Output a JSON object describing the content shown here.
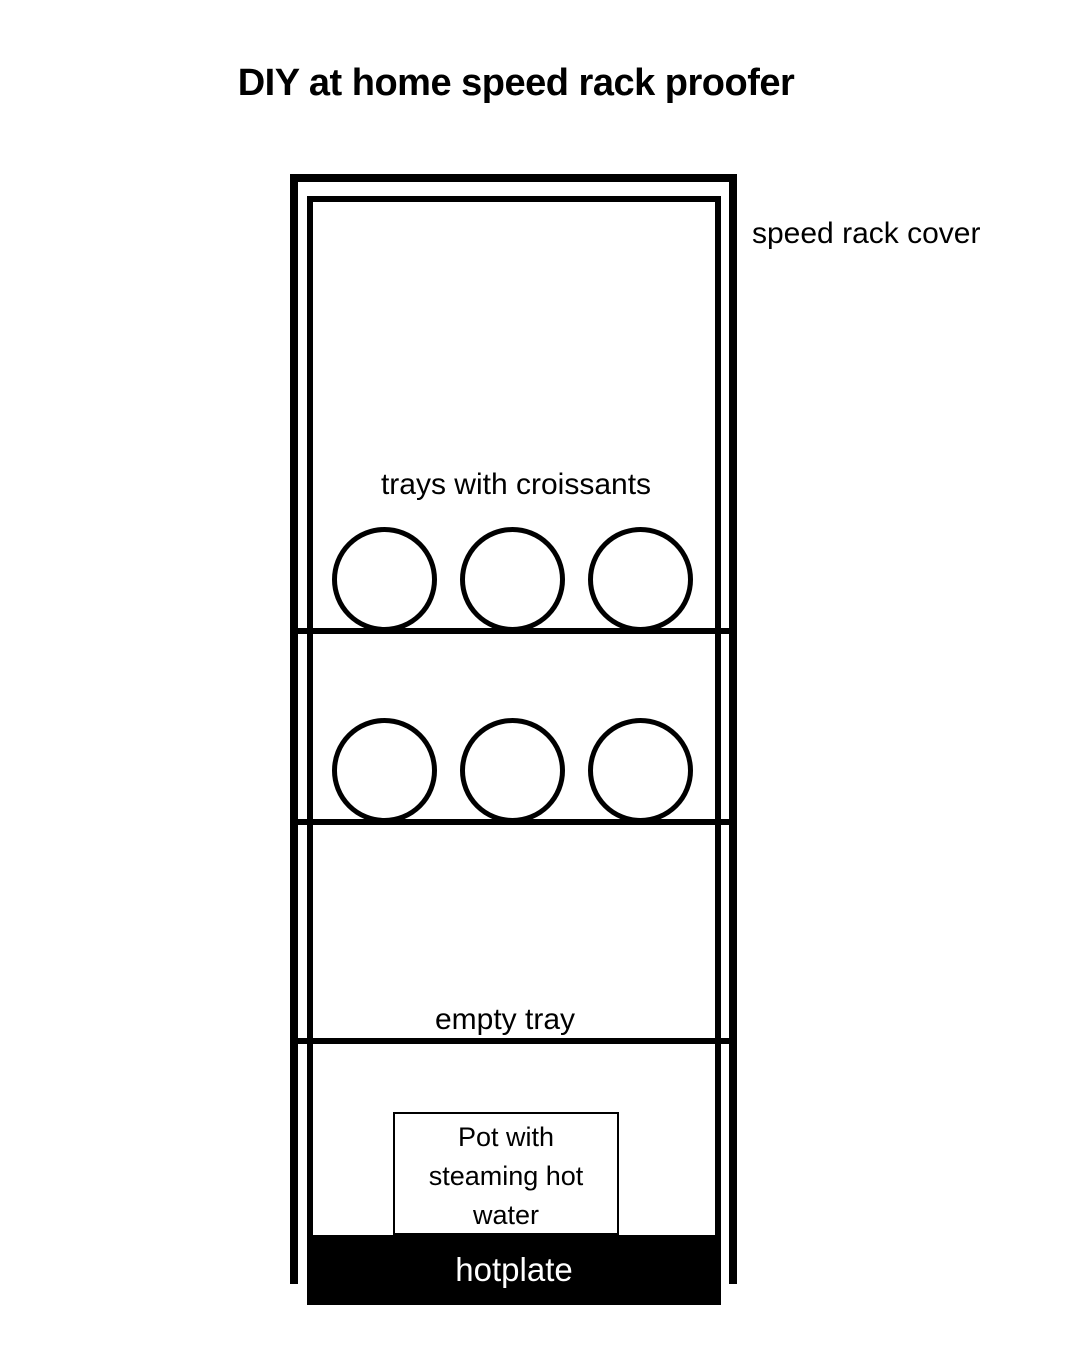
{
  "title": "DIY at home speed rack proofer",
  "diagram": {
    "cover_label": "speed rack cover",
    "trays_label": "trays with croissants",
    "empty_tray_label": "empty tray",
    "pot_label": "Pot with steaming hot water",
    "hotplate_label": "hotplate",
    "structure": {
      "shelf_lines": 3,
      "croissant_rows": 2,
      "croissants_per_row": 3
    },
    "colors": {
      "ink": "#000000",
      "background": "#ffffff",
      "hotplate_fill": "#000000",
      "hotplate_text": "#ffffff"
    }
  }
}
